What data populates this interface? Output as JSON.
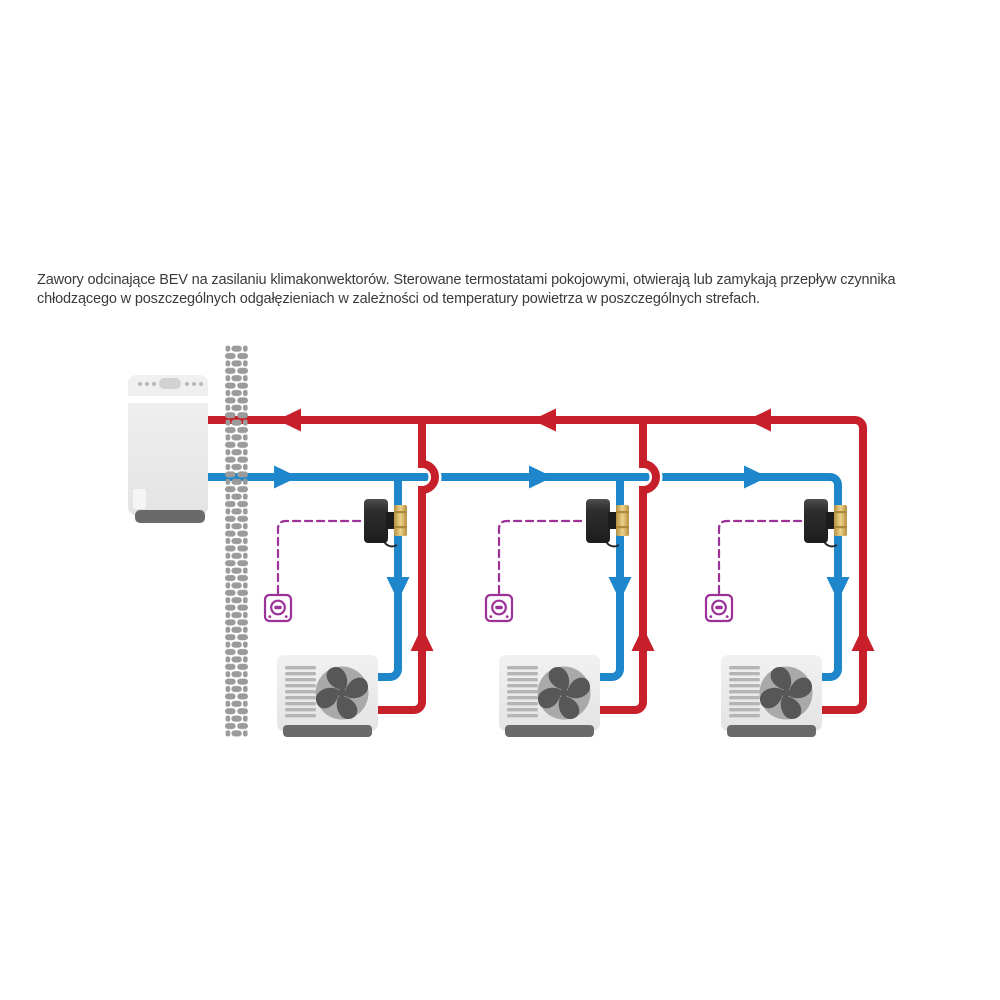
{
  "page": {
    "background": "#ffffff"
  },
  "description": {
    "text": "Zawory odcinające BEV na zasilaniu klimakonwektorów. Sterowane termostatami pokojowymi, otwierają lub zamykają przepływ czynnika chłodzącego w poszczególnych odgałęzieniach w zależności od temperatury powietrza w poszczególnych strefach."
  },
  "diagram": {
    "branch_count": 3,
    "icons": [
      "heat-pump-icon",
      "brick-wall-icon",
      "fan-coil-icon",
      "bev-valve-icon",
      "room-thermostat-icon",
      "flow-arrow-icon"
    ],
    "colors": {
      "return_pipe": "#c8202a",
      "supply_pipe": "#1e86cb",
      "control_wire": "#9c3198",
      "unit_body": "#ebebeb",
      "unit_base": "#6a6a6a",
      "brick": "#9b9b9b",
      "valve_actuator": "#2e2e2e",
      "valve_brass": "#d8b462",
      "text": "#3a3a3a"
    }
  }
}
